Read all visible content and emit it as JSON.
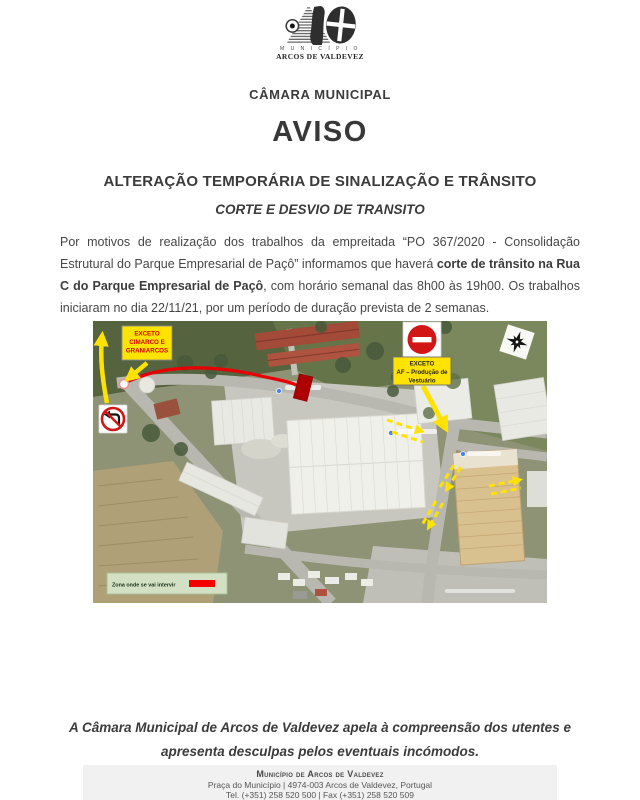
{
  "logo": {
    "municipio": "M U N I C Í P I O",
    "name": "ARCOS DE VALDEVEZ"
  },
  "header": {
    "org": "CÂMARA MUNICIPAL",
    "title": "AVISO",
    "subtitle1": "ALTERAÇÃO TEMPORÁRIA DE SINALIZAÇÃO E TRÂNSITO",
    "subtitle2": "CORTE E DESVIO DE TRANSITO"
  },
  "notice": {
    "part1": "Por motivos de realização dos trabalhos da empreitada “PO 367/2020 - Consolidação Estrutural do Parque Empresarial de Paçô” informamos que haverá ",
    "bold": "corte de trânsito na Rua C do Parque Empresarial de Paçô",
    "part2": ", com horário semanal das 8h00 às 19h00. Os trabalhos iniciaram no dia 22/11/21, por um período de duração prevista de 2 semanas."
  },
  "map": {
    "exceto_left": {
      "l1": "EXCETO",
      "l2": "CIMARCO E",
      "l3": "GRANIARCOS"
    },
    "exceto_right": {
      "l1": "EXCETO",
      "l2": "AF – Produção de",
      "l3": "Vestuário"
    },
    "legend": "Zona onde se vai intervir"
  },
  "closing": {
    "line1": "A Câmara Municipal de Arcos de Valdevez apela à compreensão dos utentes e",
    "line2": "apresenta desculpas pelos eventuais incómodos."
  },
  "footer": {
    "org": "Município de Arcos de Valdevez",
    "address": "Praça do Município | 4974-003  Arcos de Valdevez, Portugal",
    "contacts": "Tel. (+351) 258 520 500 | Fax (+351) 258 520 509"
  },
  "colors": {
    "route_red": "#e80000",
    "sign_red": "#d21616",
    "label_yellow": "#ffe300",
    "legend_green": "#d3e0c3"
  }
}
